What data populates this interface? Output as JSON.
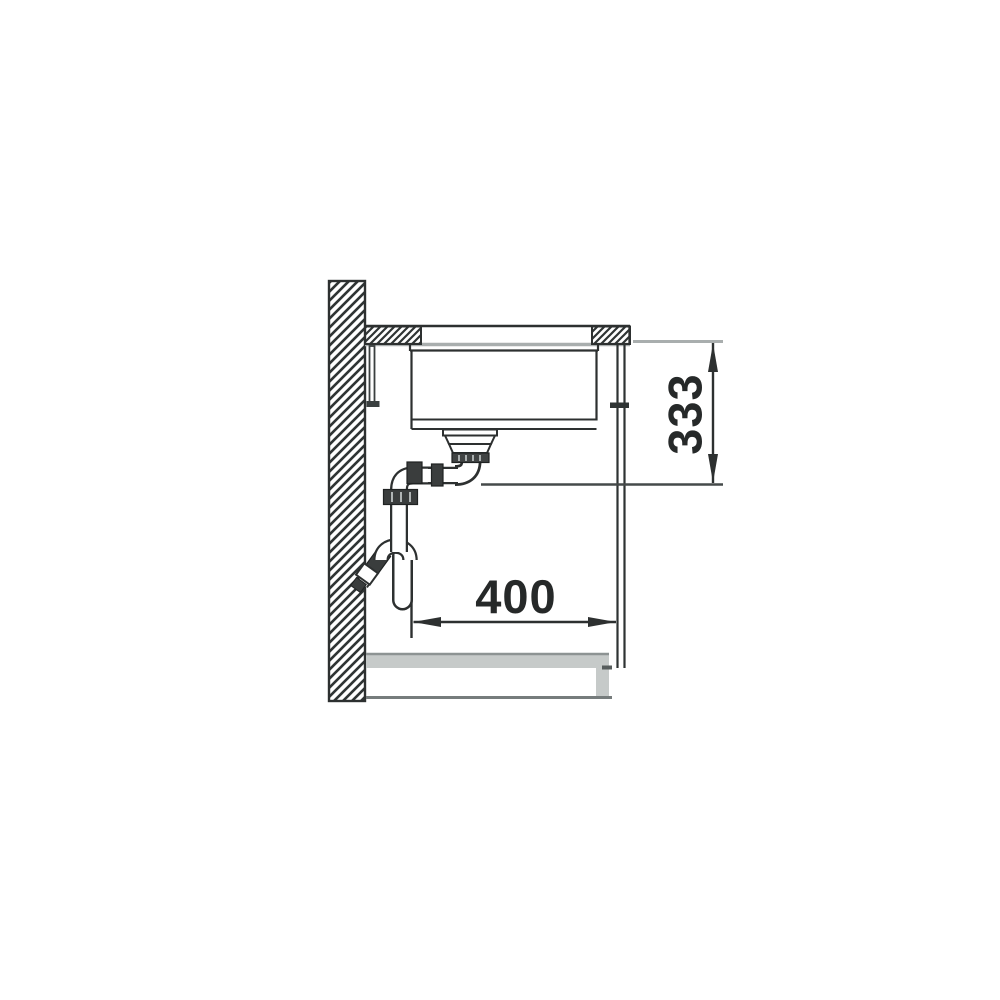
{
  "drawing": {
    "description": "sink-installation-side-section",
    "dimension_vertical_label": "333",
    "dimension_horizontal_label": "400"
  },
  "colors": {
    "line_dark": "#2d3030",
    "line_light": "#a9aeae",
    "line_mid": "#4a4f4f",
    "panel_gray": "#c6cac9",
    "fitting_dark": "#3a3d3d",
    "background": "#ffffff"
  }
}
